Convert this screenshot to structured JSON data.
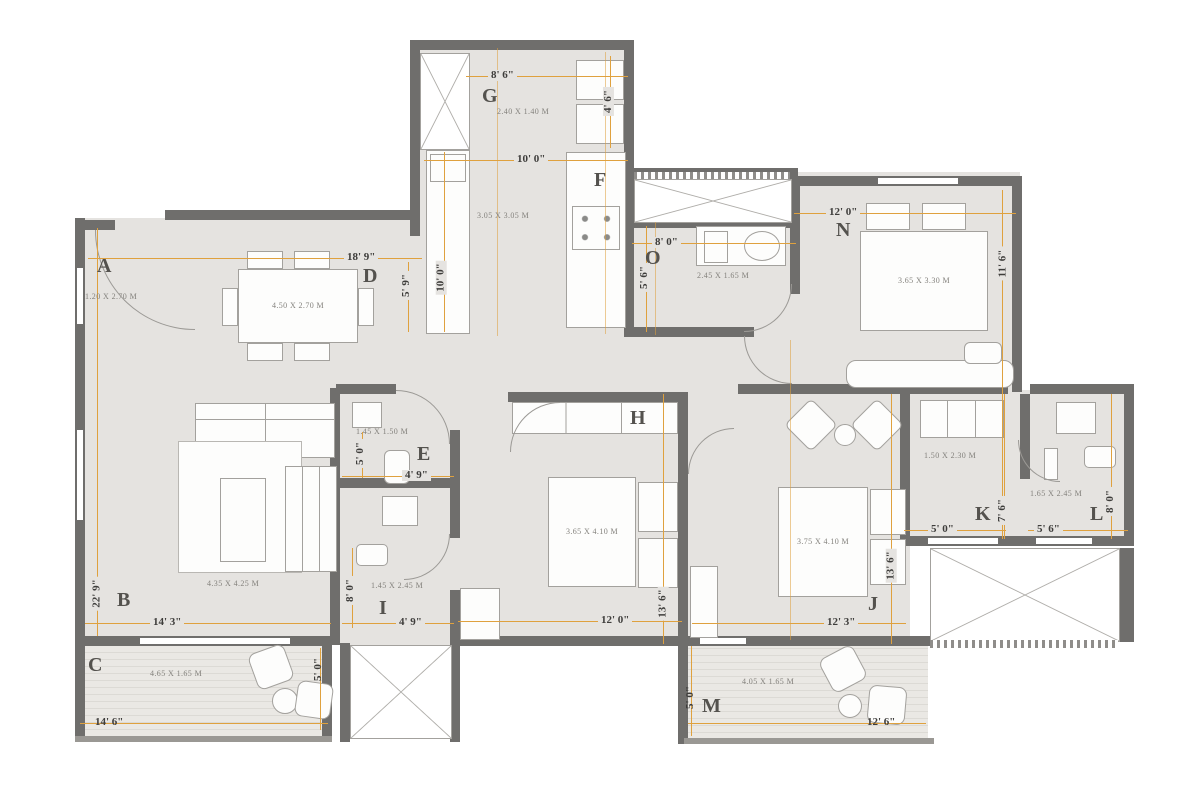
{
  "plan": {
    "colors": {
      "wall": "#6f6e6c",
      "floor": "#e5e3e0",
      "dim_line": "#dfa13e",
      "balcony_stripe": "#dcdad5"
    },
    "rooms": {
      "A": {
        "letter": "A",
        "size": "1.20 X 2.70 M"
      },
      "B": {
        "letter": "B",
        "size": "4.35 X 4.25 M",
        "w": "14' 3\"",
        "h": "22' 9\""
      },
      "C": {
        "letter": "C",
        "size": "4.65 X 1.65 M",
        "w": "14' 6\"",
        "h": "5' 0\""
      },
      "D": {
        "letter": "D",
        "size": "4.50 X 2.70 M",
        "w": "18' 9\"",
        "h": "5' 9\""
      },
      "E": {
        "letter": "E",
        "size": "1.45 X 1.50 M",
        "w": "4' 9\"",
        "h": "5' 0\""
      },
      "F": {
        "letter": "F",
        "size": "3.05 X 3.05 M",
        "w": "10' 0\"",
        "h": "10' 0\""
      },
      "G": {
        "letter": "G",
        "size": "2.40 X 1.40 M",
        "w": "8' 6\"",
        "h": "4' 6\""
      },
      "H": {
        "letter": "H",
        "size": "3.65 X 4.10 M",
        "w": "12' 0\"",
        "h": "13' 6\""
      },
      "I": {
        "letter": "I",
        "size": "1.45 X 2.45 M",
        "w": "4' 9\"",
        "h": "8' 0\""
      },
      "J": {
        "letter": "J",
        "size": "3.75 X 4.10 M",
        "w": "12' 3\"",
        "h": "13' 6\""
      },
      "K": {
        "letter": "K",
        "size": "1.50 X 2.30 M",
        "w": "5' 0\"",
        "h": "7' 6\""
      },
      "L": {
        "letter": "L",
        "size": "1.65 X 2.45 M",
        "w": "5' 6\"",
        "h": "8' 0\""
      },
      "M": {
        "letter": "M",
        "size": "4.05 X 1.65 M",
        "w": "12' 6\"",
        "h": "5' 0\""
      },
      "N": {
        "letter": "N",
        "size": "3.65 X 3.30 M",
        "w": "12' 0\"",
        "h": "11' 6\""
      },
      "O": {
        "letter": "O",
        "size": "2.45 X 1.65 M",
        "w": "8' 0\"",
        "h": "5' 6\""
      }
    }
  }
}
